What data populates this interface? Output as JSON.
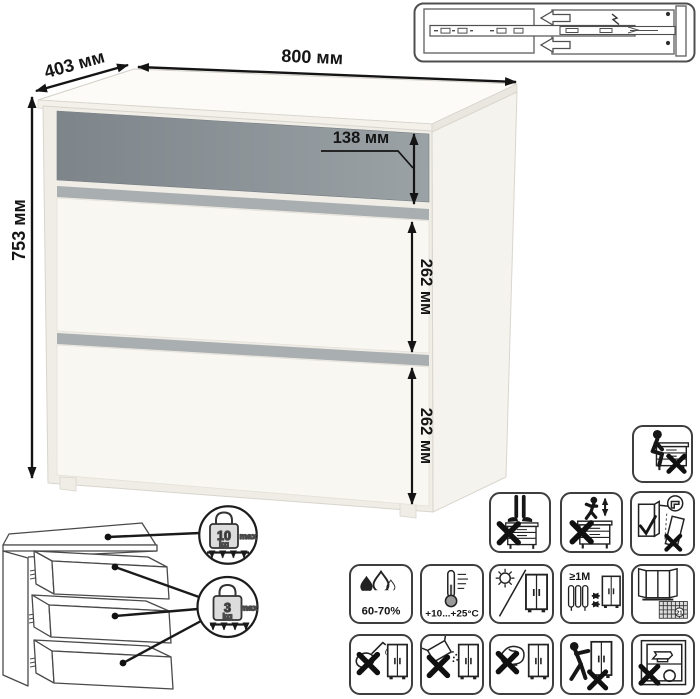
{
  "dimensions": {
    "width": "800 мм",
    "depth": "403 мм",
    "height": "753 мм",
    "drawer_top": "138 мм",
    "drawer_middle": "262 мм",
    "drawer_bottom": "262 мм"
  },
  "load_limits": {
    "top_surface": {
      "value": "10",
      "unit": "kg",
      "qualifier": "max"
    },
    "drawers": {
      "value": "3",
      "unit": "kg",
      "qualifier": "max"
    }
  },
  "care": {
    "humidity": "60-70%",
    "temperature": "+10...+25°C",
    "min_heat_distance": "≥1M",
    "calendar_day": "21"
  },
  "icon_names": [
    "drawer-slide-mechanism-diagram",
    "no-sitting-on-top",
    "no-standing-on-top",
    "no-jumping-on-top",
    "anchor-to-wall",
    "humidity-range",
    "temperature-range",
    "no-direct-sunlight",
    "keep-distance-from-heat-source",
    "acclimatize-21-days",
    "no-aggressive-liquids",
    "no-abrasive-powders",
    "no-abrasive-sponges",
    "no-dragging",
    "no-overloading"
  ],
  "colors": {
    "drawer_accent_dark": "#7e858a",
    "drawer_accent_light": "#9ba2a6",
    "divider_gray": "#a9aeb1",
    "body_white": "#f7f5ef",
    "outline": "#2b2b2b",
    "dimension_text": "#151515"
  }
}
